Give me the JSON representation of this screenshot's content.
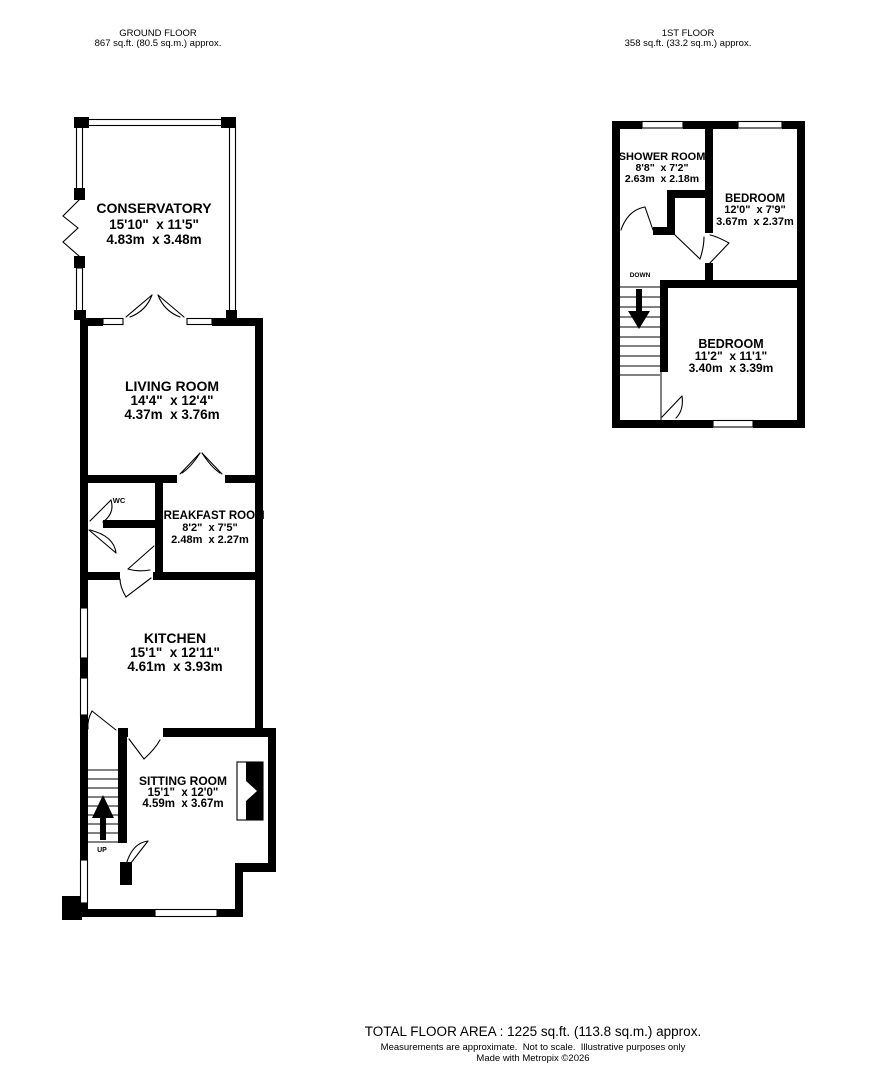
{
  "ground_floor": {
    "header_title": "GROUND FLOOR",
    "header_area": "867 sq.ft. (80.5 sq.m.) approx.",
    "stairs_label": "UP",
    "rooms": {
      "conservatory": {
        "name": "CONSERVATORY",
        "imperial": "15'10\"  x 11'5\"",
        "metric": "4.83m  x 3.48m"
      },
      "living_room": {
        "name": "LIVING ROOM",
        "imperial": "14'4\"  x 12'4\"",
        "metric": "4.37m  x 3.76m"
      },
      "wc": {
        "name": "WC"
      },
      "breakfast_room": {
        "name": "BREAKFAST ROOM",
        "imperial": "8'2\"  x 7'5\"",
        "metric": "2.48m  x 2.27m"
      },
      "kitchen": {
        "name": "KITCHEN",
        "imperial": "15'1\"  x 12'11\"",
        "metric": "4.61m  x 3.93m"
      },
      "sitting_room": {
        "name": "SITTING ROOM",
        "imperial": "15'1\"  x 12'0\"",
        "metric": "4.59m  x 3.67m"
      }
    }
  },
  "first_floor": {
    "header_title": "1ST FLOOR",
    "header_area": "358 sq.ft. (33.2 sq.m.) approx.",
    "stairs_label": "DOWN",
    "rooms": {
      "shower_room": {
        "name": "SHOWER ROOM",
        "imperial": "8'8\"  x 7'2\"",
        "metric": "2.63m  x 2.18m"
      },
      "bedroom_1": {
        "name": "BEDROOM",
        "imperial": "12'0\"  x 7'9\"",
        "metric": "3.67m  x 2.37m"
      },
      "bedroom_2": {
        "name": "BEDROOM",
        "imperial": "11'2\"  x 11'1\"",
        "metric": "3.40m  x 3.39m"
      }
    }
  },
  "footer": {
    "total_area": "TOTAL FLOOR AREA : 1225 sq.ft. (113.8 sq.m.) approx.",
    "disclaimer": "Measurements are approximate.  Not to scale.  Illustrative purposes only",
    "credit": "Made with Metropix ©2026"
  },
  "colors": {
    "ink": "#000000",
    "paper": "#ffffff"
  }
}
